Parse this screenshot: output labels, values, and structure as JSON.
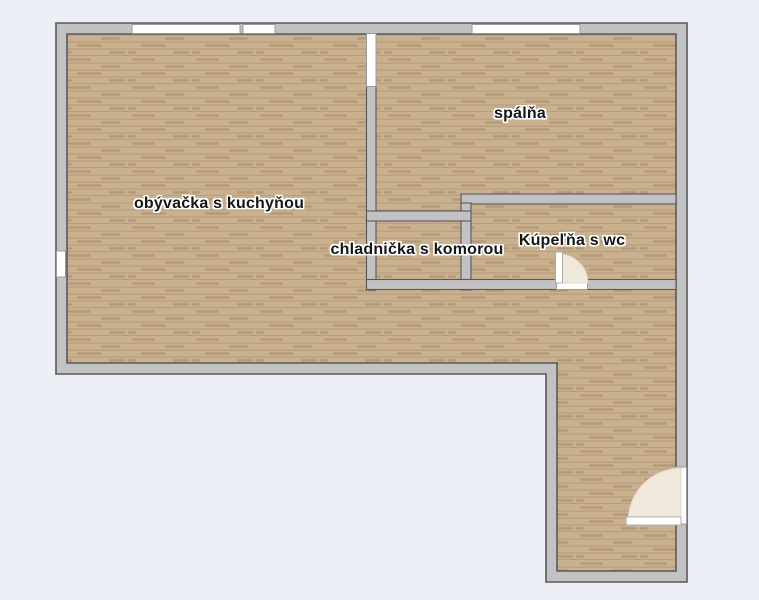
{
  "plan": {
    "type": "apartment-floor-plan",
    "rooms": [
      {
        "label": "obývačka s kuchyňou"
      },
      {
        "label": "spálňa"
      },
      {
        "label": "chladnička s komorou"
      },
      {
        "label": "Kúpeľňa s wc"
      }
    ]
  },
  "colors": {
    "background": "#edeff6",
    "wall_fill": "#c2c2c4",
    "wall_outline": "#59595c",
    "floor_base": "#c9b08f",
    "floor_line": "rgba(125,95,62,0.30)",
    "floor_streak": "rgba(130,98,62,0.28)",
    "window_fill": "#ffffff",
    "window_border": "#9a9a9c",
    "door_leaf": "#ffffff",
    "door_swing": "#f0e8da"
  }
}
